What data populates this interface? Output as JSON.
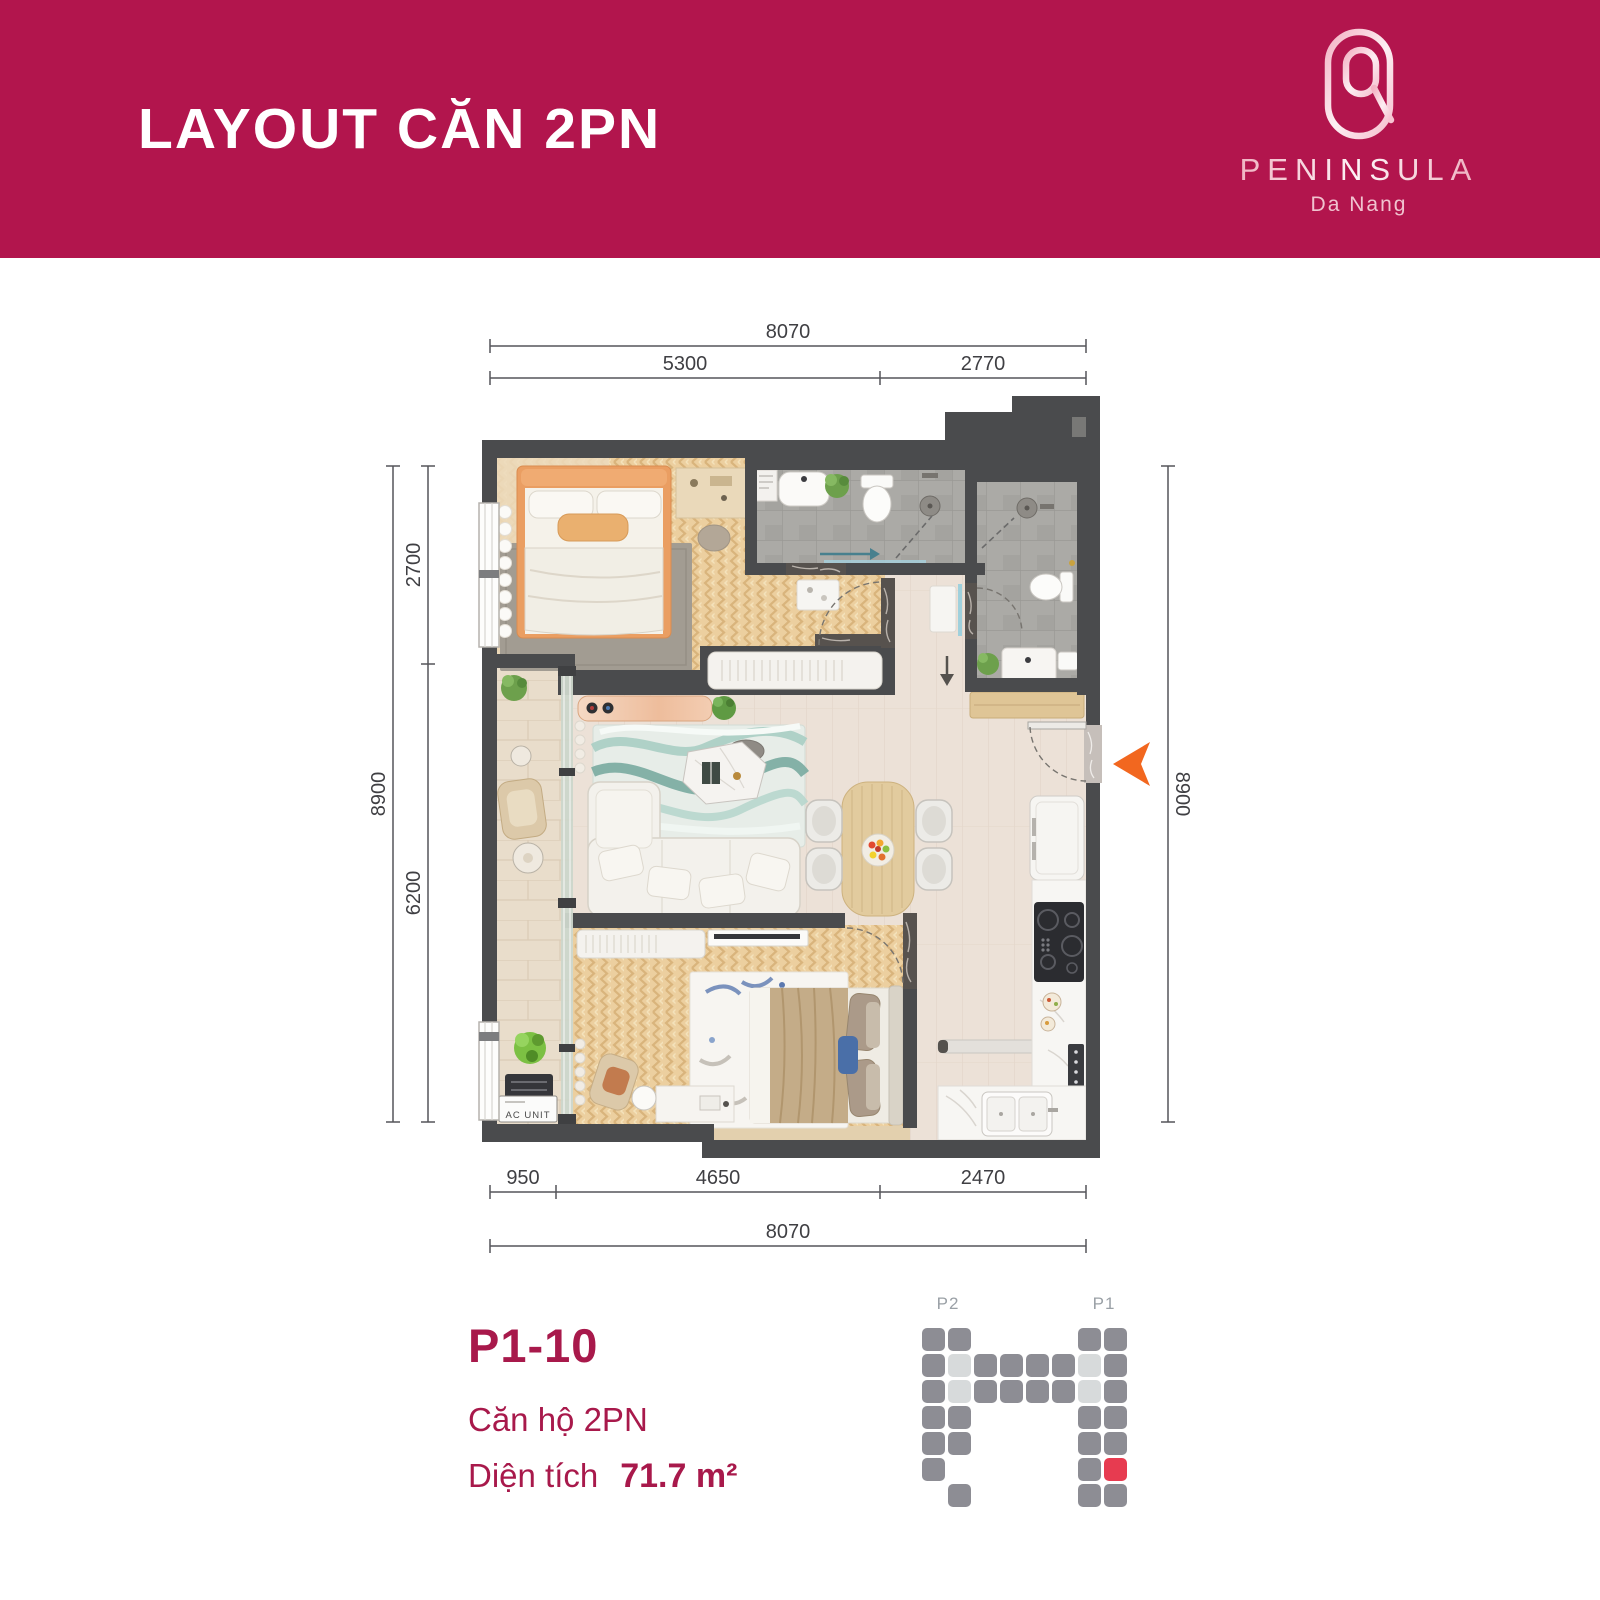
{
  "banner": {
    "title": "LAYOUT CĂN 2PN",
    "bg_color": "#b2154d"
  },
  "logo": {
    "brand": "PENINSULA",
    "city": "Da Nang"
  },
  "plan": {
    "dims": {
      "top_total": "8070",
      "top_left": "5300",
      "top_right": "2770",
      "left_total": "8900",
      "left_upper": "2700",
      "left_lower": "6200",
      "right_total": "8900",
      "bottom_left": "950",
      "bottom_mid": "4650",
      "bottom_right": "2470",
      "bottom_total": "8070"
    },
    "labels": {
      "ac_unit": "AC UNIT"
    },
    "entrance_arrow_color": "#f2671f",
    "wall_color": "#4a4b4d"
  },
  "info": {
    "unit_code": "P1-10",
    "unit_type": "Căn hộ 2PN",
    "area_label": "Diện tích",
    "area_value": "71.7 m²"
  },
  "minimap": {
    "towers": [
      {
        "label": "P2"
      },
      {
        "label": "P1"
      }
    ],
    "grid": {
      "origin_x": 922,
      "origin_y": 1328,
      "pitch": 26,
      "cell": 23,
      "radius": 5
    },
    "colors": {
      "gray": "#8d8d94",
      "light": "#d7dadb",
      "red": "#e73b50"
    },
    "cells": [
      {
        "c": 0,
        "r": 0,
        "t": "g"
      },
      {
        "c": 0,
        "r": 1,
        "t": "g"
      },
      {
        "c": 0,
        "r": 2,
        "t": "g"
      },
      {
        "c": 0,
        "r": 3,
        "t": "g"
      },
      {
        "c": 0,
        "r": 4,
        "t": "g"
      },
      {
        "c": 0,
        "r": 5,
        "t": "g"
      },
      {
        "c": 1,
        "r": 0,
        "t": "g"
      },
      {
        "c": 1,
        "r": 1,
        "t": "l"
      },
      {
        "c": 1,
        "r": 2,
        "t": "l"
      },
      {
        "c": 1,
        "r": 3,
        "t": "g"
      },
      {
        "c": 1,
        "r": 4,
        "t": "g"
      },
      {
        "c": 1,
        "r": 6,
        "t": "g"
      },
      {
        "c": 2,
        "r": 1,
        "t": "g"
      },
      {
        "c": 2,
        "r": 2,
        "t": "g"
      },
      {
        "c": 3,
        "r": 1,
        "t": "g"
      },
      {
        "c": 3,
        "r": 2,
        "t": "g"
      },
      {
        "c": 4,
        "r": 1,
        "t": "g"
      },
      {
        "c": 4,
        "r": 2,
        "t": "g"
      },
      {
        "c": 5,
        "r": 1,
        "t": "g"
      },
      {
        "c": 5,
        "r": 2,
        "t": "g"
      },
      {
        "c": 6,
        "r": 0,
        "t": "g"
      },
      {
        "c": 6,
        "r": 1,
        "t": "l"
      },
      {
        "c": 6,
        "r": 2,
        "t": "l"
      },
      {
        "c": 6,
        "r": 3,
        "t": "g"
      },
      {
        "c": 6,
        "r": 4,
        "t": "g"
      },
      {
        "c": 6,
        "r": 5,
        "t": "g"
      },
      {
        "c": 6,
        "r": 6,
        "t": "g"
      },
      {
        "c": 7,
        "r": 0,
        "t": "g"
      },
      {
        "c": 7,
        "r": 1,
        "t": "g"
      },
      {
        "c": 7,
        "r": 2,
        "t": "g"
      },
      {
        "c": 7,
        "r": 3,
        "t": "g"
      },
      {
        "c": 7,
        "r": 4,
        "t": "g"
      },
      {
        "c": 7,
        "r": 5,
        "t": "r"
      },
      {
        "c": 7,
        "r": 6,
        "t": "g"
      }
    ]
  }
}
